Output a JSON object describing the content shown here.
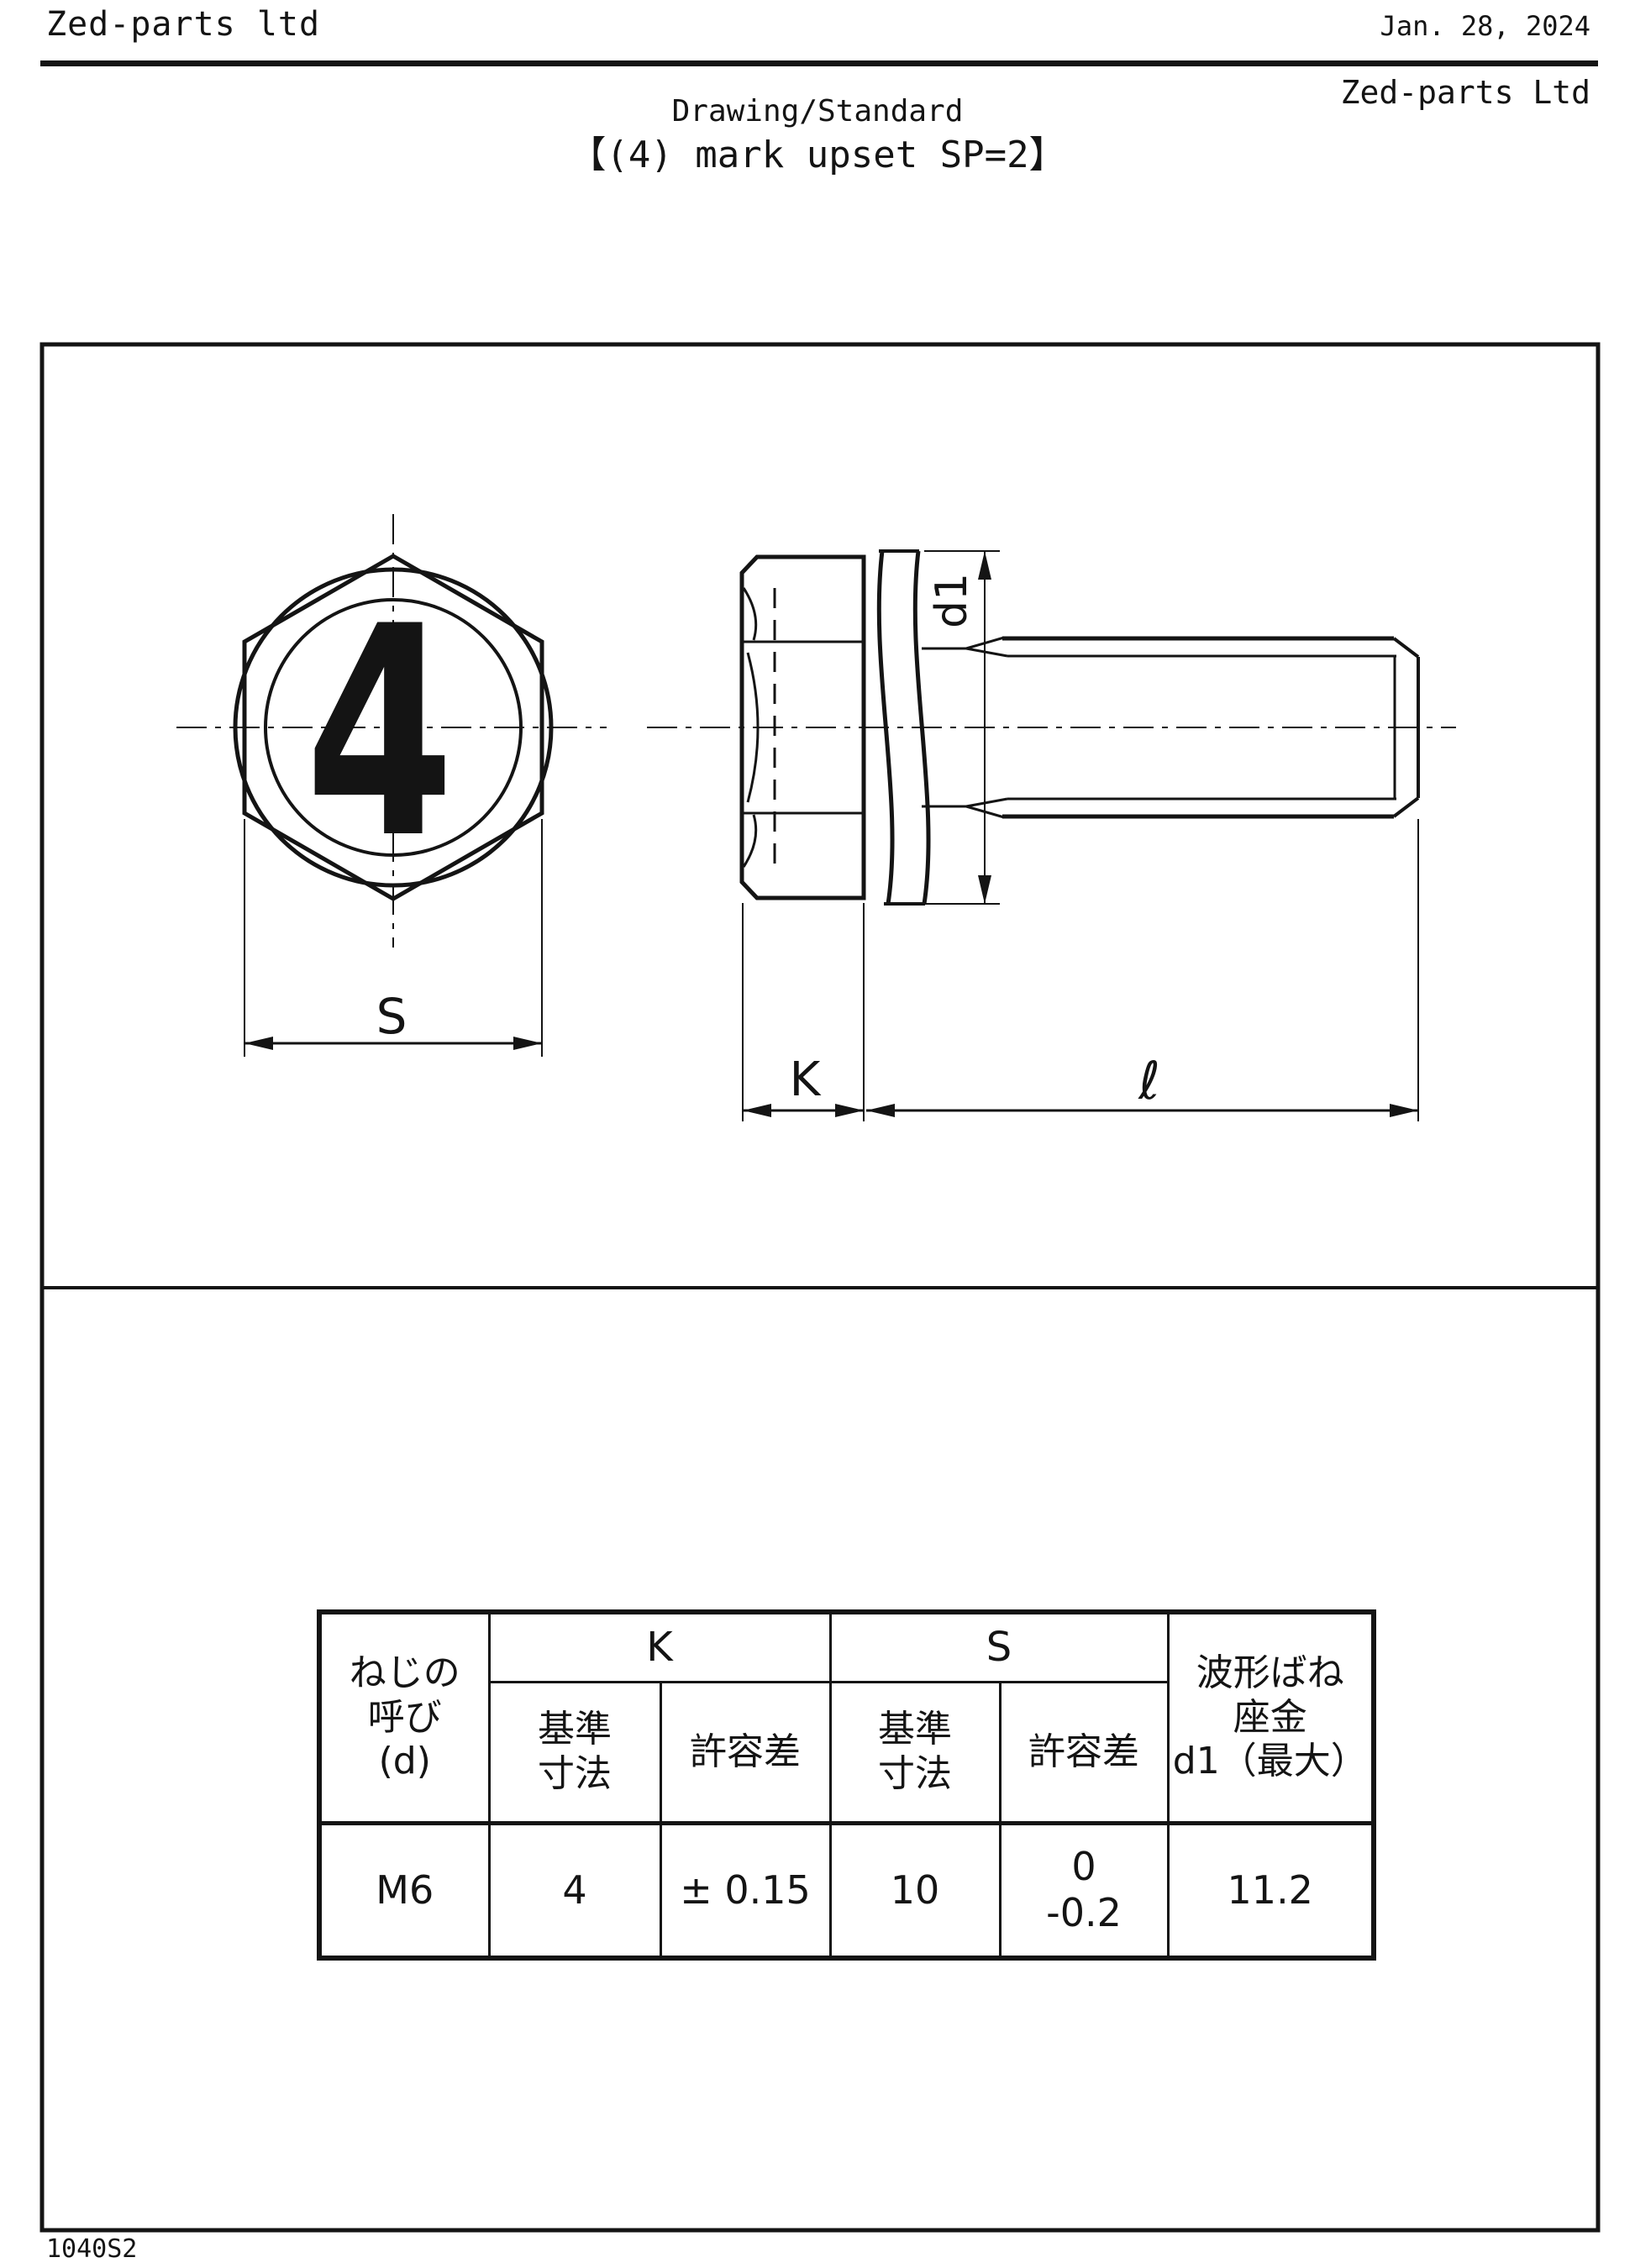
{
  "header": {
    "company_top": "Zed-parts ltd",
    "date": "Jan. 28, 2024",
    "company_right": "Zed-parts Ltd",
    "doc_type": "Drawing/Standard",
    "title": "【(4) mark upset SP=2】"
  },
  "drawing": {
    "labels": {
      "mark": "4",
      "s": "S",
      "k": "K",
      "length": "ℓ",
      "d1": "d1"
    }
  },
  "table": {
    "headers": {
      "thread": "ねじの\n呼び\n(d)",
      "k": "K",
      "s": "S",
      "basic": "基準\n寸法",
      "tolerance": "許容差",
      "washer": "波形ばね\n座金\nd1（最大）"
    },
    "row": {
      "thread": "M6",
      "k_basic": "4",
      "k_tol": "± 0.15",
      "s_basic": "10",
      "s_tol": "0\n-0.2",
      "d1": "11.2"
    }
  },
  "footer": {
    "code": "1040S2"
  },
  "colors": {
    "ink": "#141414",
    "background": "#ffffff"
  }
}
